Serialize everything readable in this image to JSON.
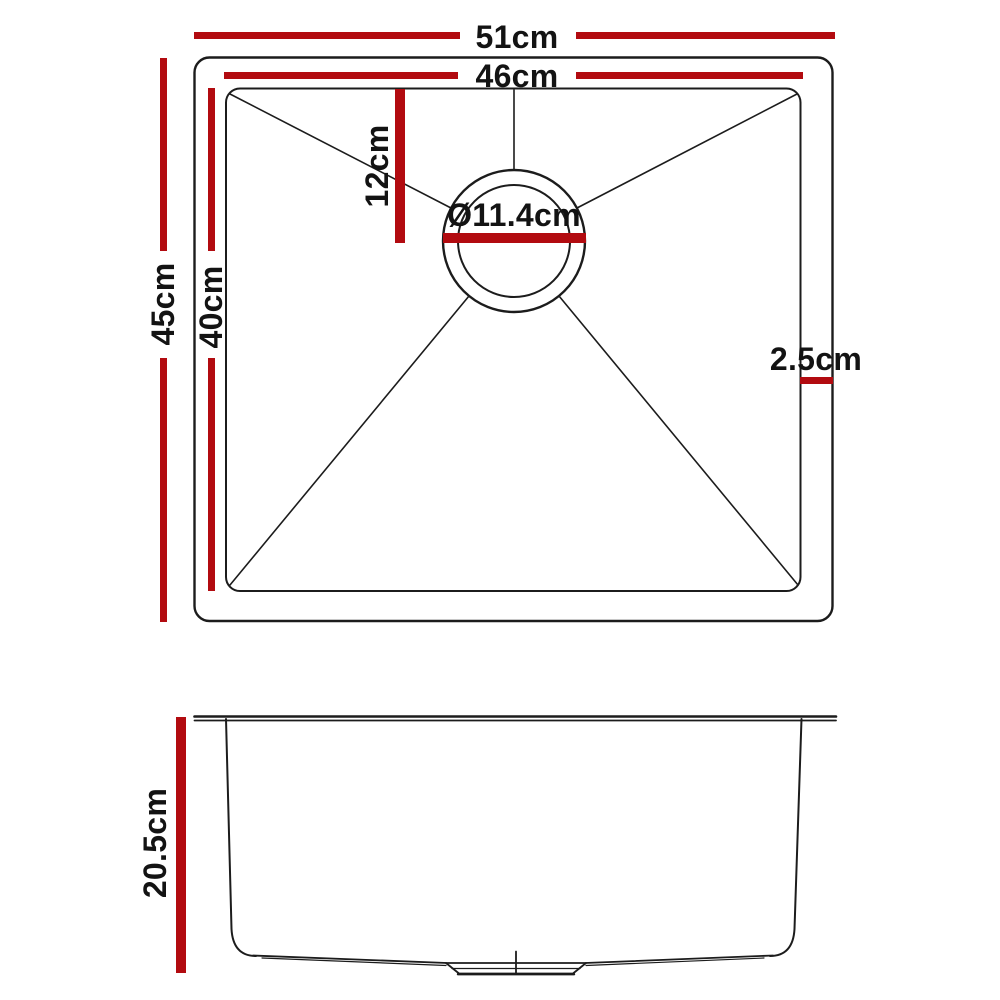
{
  "colors": {
    "dimension_red": "#b20b10",
    "line_black": "#1c1c1c",
    "text_black": "#131313"
  },
  "top_view": {
    "overall_width": "51cm",
    "bowl_width": "46cm",
    "overall_depth": "45cm",
    "bowl_depth": "40cm",
    "drain_distance_from_top": "12cm",
    "drain_diameter": "Ø11.4cm",
    "rim_width": "2.5cm"
  },
  "side_view": {
    "bowl_height": "20.5cm"
  }
}
